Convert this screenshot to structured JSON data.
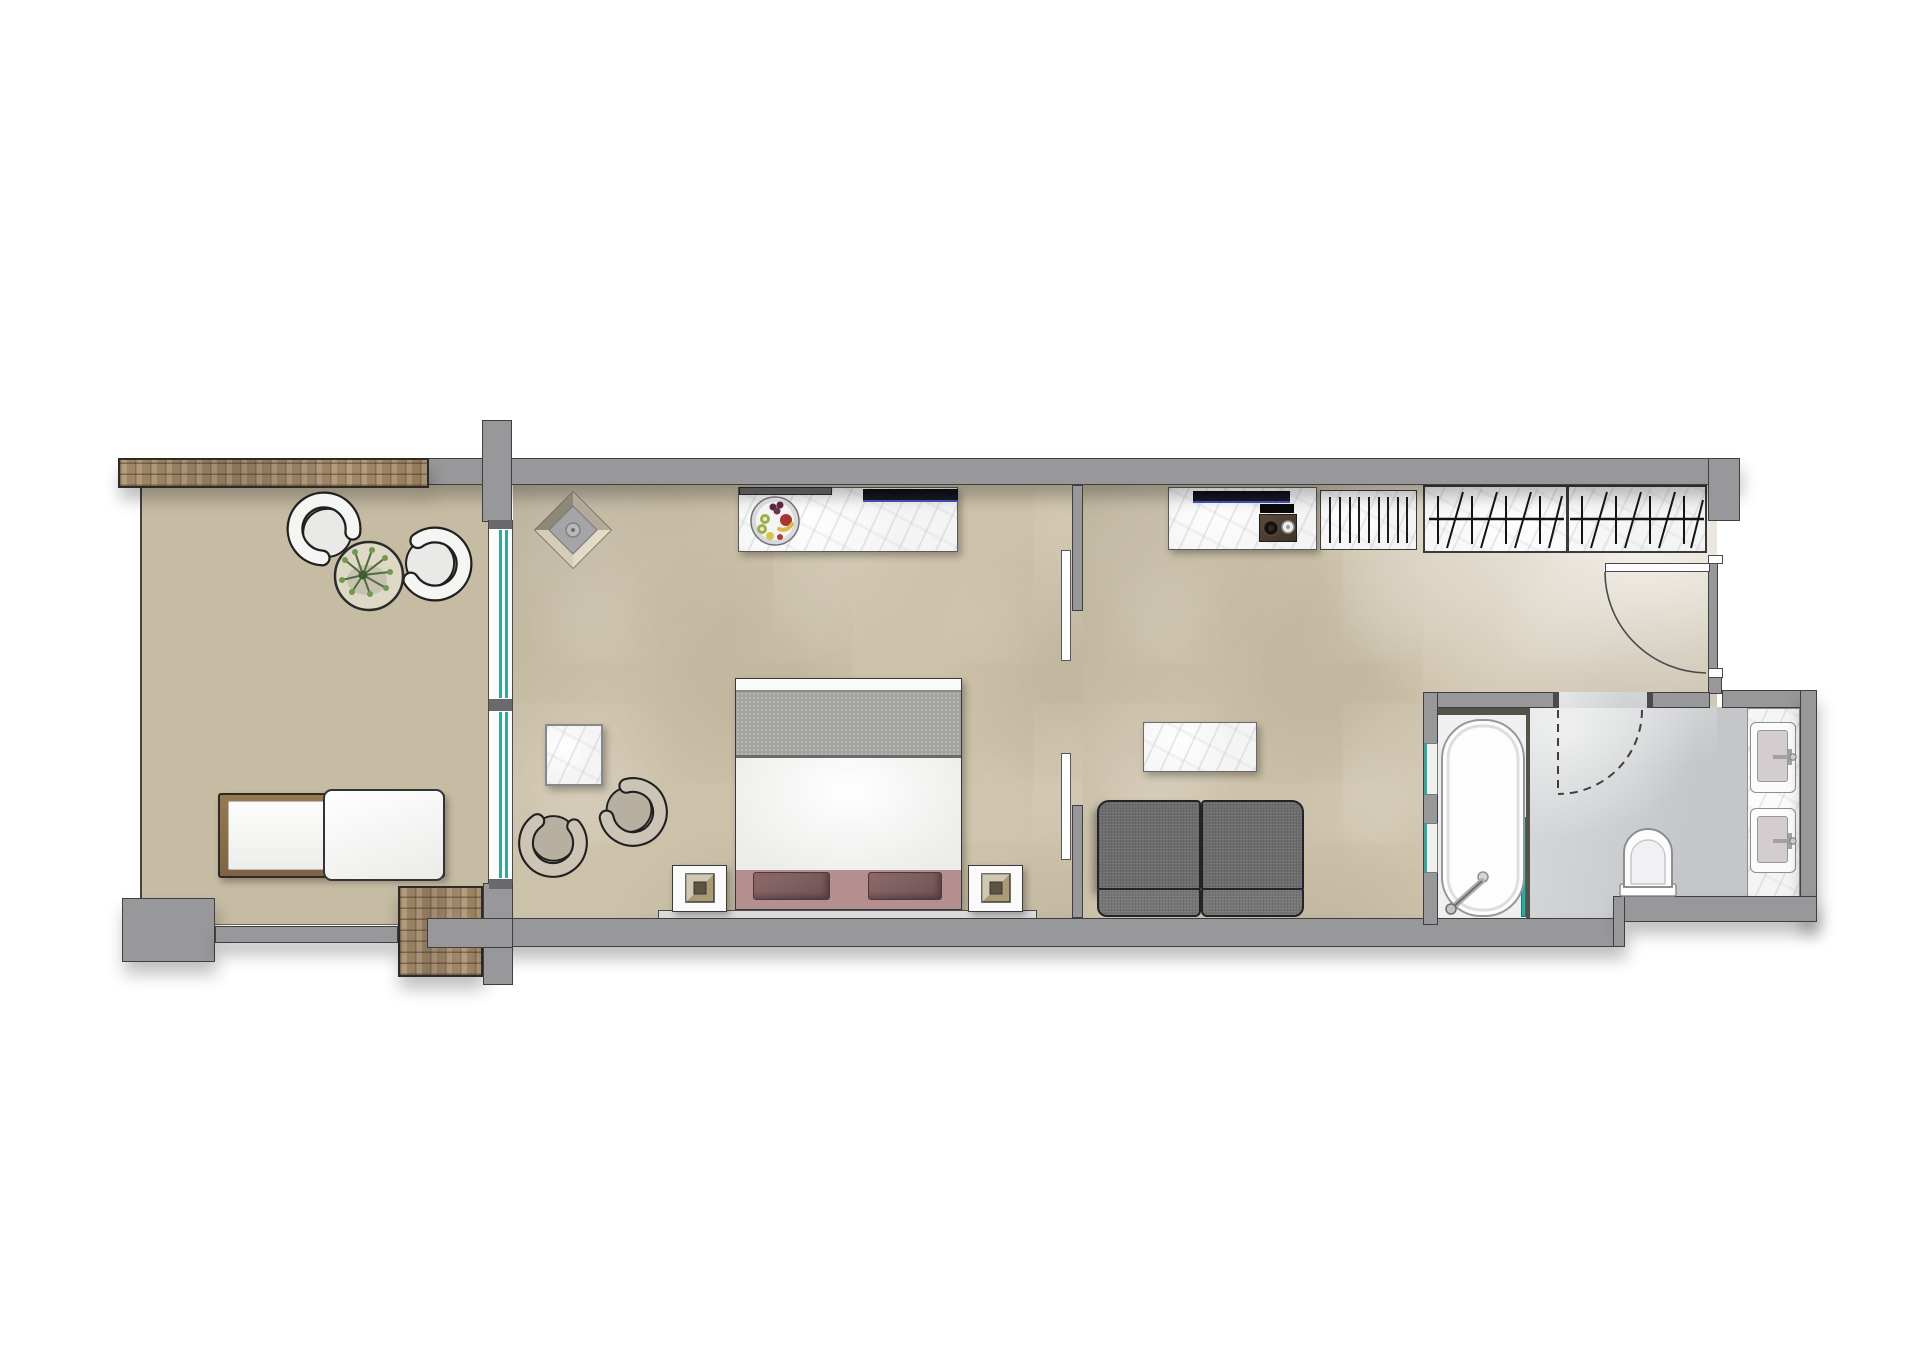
{
  "title": "hotel-suite-floor-plan",
  "colors": {
    "floor_main": "#ccc1a9",
    "floor_terrace": "#c6bba3",
    "wall": "#98989a",
    "wall_line": "#3f3f41",
    "stone": "#9c8164",
    "marble": "#f4f4f5",
    "teal": "#35a79c",
    "bath_floor": "#ced1d3",
    "tub_floor": "#f0f0f1",
    "tub_trim": "#55524a",
    "sofa": "#6d6d6d",
    "sofa_line": "#23232a",
    "bed_blanket": "#a3a3a1",
    "bed_duvet": "#f6f6f5",
    "bed_bench": "#b58f90",
    "bench_cushion": "#7f5c5e",
    "wood": "#8d714c",
    "chair_terrace_band": "#f5f5f3",
    "chair_terrace_seat": "#e9e9e7",
    "chair_bedroom_band": "#ccc4b4",
    "chair_bedroom_seat": "#b7af9f",
    "tv_dark": "#12121a",
    "tv_blue": "#4656b8",
    "lamp_tan": "#a99b76",
    "plant_green": "#4e6e3e",
    "table_cream": "#ded8c6"
  },
  "labels": {
    "plan": "Hotel suite floor plan",
    "terrace": "Terrace",
    "bedroom": "Bedroom",
    "living": "Living room with kitchenette",
    "bathroom": "Bathroom",
    "stone_wall": "Natural stone wall",
    "stone_pier": "Natural stone pier",
    "glass_door": "Sliding glass door to terrace",
    "pocket_door": "Sliding pocket door",
    "entry_door": "Entry door",
    "outdoor_chair": "Outdoor armchair",
    "outdoor_table": "Outdoor side table with plant",
    "lounger": "Sun lounger",
    "diamond_lamp": "Decorative ceiling lamp",
    "console": "Dresser console",
    "tv": "Wall-mounted TV",
    "fruit_plate": "Fruit plate",
    "bed": "Double bed",
    "bench": "Foot-of-bed bench",
    "nightstand": "Nightstand with lamp",
    "side_table": "Marble side table",
    "armchair": "Lounge armchair",
    "kitchenette": "Kitchenette counter",
    "cooktop": "Two-burner cooktop",
    "luggage_rack": "Luggage rack / louvered unit",
    "wardrobe": "Wardrobe with hangers",
    "coffee_table": "Marble coffee table",
    "sofa": "Two-seat sofa",
    "bathtub": "Bathtub",
    "glass_screen": "Glass bath screen",
    "niche": "Storage niche",
    "shower_door": "Shower door swing",
    "toilet": "Toilet",
    "vanity": "Double vanity",
    "sink": "Sink"
  },
  "rooms": [
    {
      "name": "terrace",
      "items": [
        "outdoor armchair",
        "outdoor armchair",
        "outdoor table with plant",
        "sun lounger"
      ]
    },
    {
      "name": "bedroom",
      "items": [
        "double bed",
        "nightstand x2",
        "dresser console with TV",
        "fruit plate",
        "side table",
        "armchair x2",
        "ceiling lamp"
      ]
    },
    {
      "name": "living room",
      "items": [
        "sofa",
        "coffee table",
        "kitchenette with cooktop and TV",
        "luggage rack",
        "wardrobe",
        "entry door"
      ]
    },
    {
      "name": "bathroom",
      "items": [
        "bathtub",
        "glass screen",
        "storage niches x2",
        "walk-in shower",
        "toilet",
        "double vanity"
      ]
    }
  ]
}
